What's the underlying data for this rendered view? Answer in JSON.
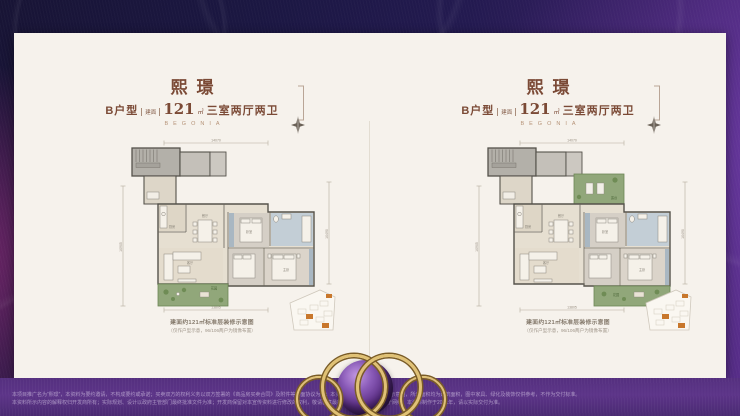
{
  "panels": [
    {
      "title": "熙璟",
      "type_label": "B户型",
      "area_tag": "建面",
      "area_value": "121",
      "area_unit": "㎡",
      "layout_label": "三室两厅两卫",
      "brand": "BEGONIA",
      "caption_line1": "建面约121㎡标准层装修示意图",
      "caption_line2": "（仅作户型示意，96/106两户为镜像布置）"
    },
    {
      "title": "熙璟",
      "type_label": "B户型",
      "area_tag": "建面",
      "area_value": "121",
      "area_unit": "㎡",
      "layout_label": "三室两厅两卫",
      "brand": "BEGONIA",
      "caption_line1": "建面约121㎡标准层装修示意图",
      "caption_line2": "（仅作户型示意，96/106两户为镜像布置）"
    }
  ],
  "dims": {
    "top": "14070",
    "bottom": "13805",
    "left": "10905",
    "right": "10490"
  },
  "rooms": {
    "dining": "餐厅",
    "living": "客厅",
    "master": "主卧",
    "bedroom": "卧室",
    "kitchen": "厨房",
    "garden": "花园",
    "terrace": "露台"
  },
  "footer": {
    "line1": "本项目推广名为“熙璟”，本资料为要约邀请，不构成要约或承诺；买卖双方的权利义务以双方签署的《商品房买卖合同》及附件等书面协议为准；本资料所示户型图仅为装修示意图，所示面积均为建筑面积，图中家具、绿化及装饰仅供参考，不作为交付标准。",
    "line2": "本资料所示内容的解释权归开发商所有；实际规划、设计以政府主管部门最终批准文件为准；开发商保留对本宣传资料进行修改的权利，敬请留意最新资料；部分图片来源于网络，本资料制作于2021年，请以实际交付为准。"
  }
}
